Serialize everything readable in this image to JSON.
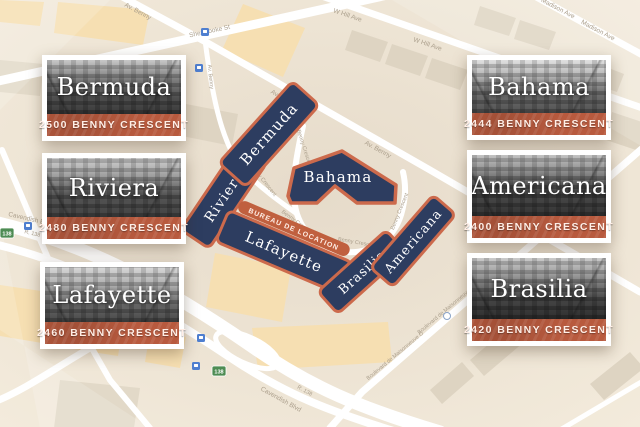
{
  "cards": [
    {
      "name": "Bermuda",
      "address": "2500 BENNY CRESCENT"
    },
    {
      "name": "Riviera",
      "address": "2480 BENNY CRESCENT"
    },
    {
      "name": "Lafayette",
      "address": "2460 BENNY CRESCENT"
    },
    {
      "name": "Bahama",
      "address": "2444 BENNY CRESCENT"
    },
    {
      "name": "Americana",
      "address": "2400 BENNY CRESCENT"
    },
    {
      "name": "Brasilia",
      "address": "2420 BENNY CRESCENT"
    }
  ],
  "map": {
    "footprints": {
      "bermuda": "Bermuda",
      "riviera": "Riviera",
      "bahama": "Bahama",
      "lafayette": "Lafayette",
      "brasilia": "Brasilia",
      "americana": "Americana"
    },
    "leasing_banner": "BUREAU DE LOCATION",
    "streets": {
      "sherbrooke": "Sherbrooke St",
      "av_benny": "Av. Benny",
      "benny_crescent": "Benny Crescent",
      "w_hill": "W Hill Ave",
      "madison": "Madison Ave",
      "cavendish": "Cavendish Blvd",
      "route_138": "R. 138",
      "maisonneuve": "Boulevard de Maisonneuve O"
    },
    "route_shield": "138",
    "colors": {
      "footprint_fill": "#2d3d60",
      "footprint_stroke": "#cc6a4c",
      "banner_red": "#b85a3e",
      "map_background": "#e9dfd0",
      "street_white": "#ffffff",
      "block_orange": "#f6dfb2",
      "block_tan": "#ded4c2"
    }
  }
}
